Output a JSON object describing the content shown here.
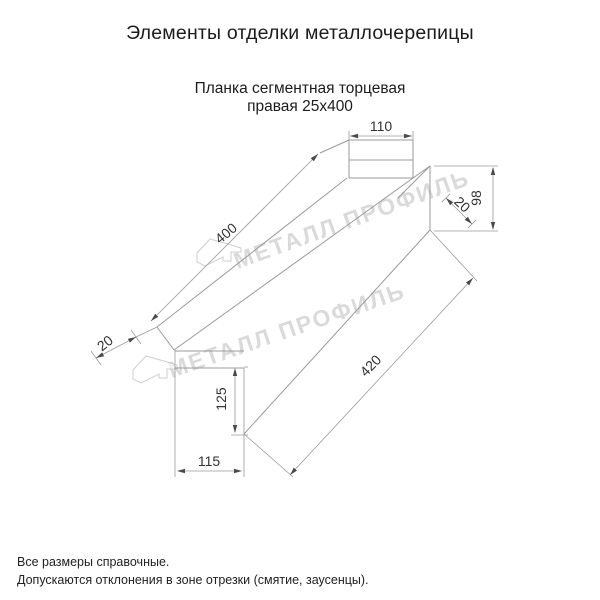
{
  "header": {
    "title": "Элементы отделки металлочерепицы"
  },
  "subtitle": {
    "line1": "Планка сегментная торцевая",
    "line2": "правая 25х400"
  },
  "watermark": {
    "text": "МЕТАЛЛ ПРОФИЛЬ",
    "color": "#dadada",
    "logo_icon": "metall-profil-bird-logo"
  },
  "drawing": {
    "line_color": "#9a9a9a",
    "dim_text_color": "#333333",
    "dimensions": {
      "top_flange_width": "110",
      "right_end_height": "98",
      "right_hem": "20",
      "length_upper": "400",
      "left_hem": "20",
      "length_lower": "420",
      "bottom_end_height": "125",
      "bottom_flange_width": "115"
    }
  },
  "footer": {
    "note1": "Все размеры справочные.",
    "note2": "Допускаются отклонения в зоне отрезки (смятие, заусенцы)."
  }
}
